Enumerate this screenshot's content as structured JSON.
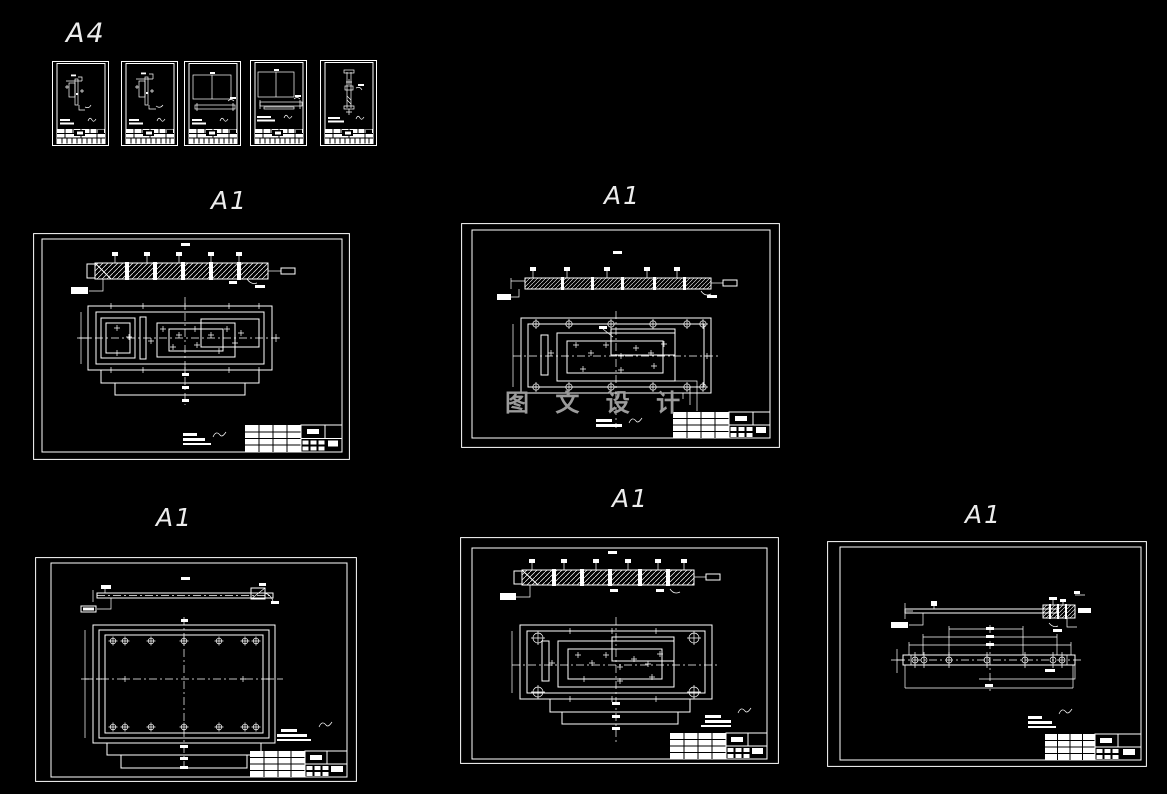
{
  "page": {
    "background_color": "#000000",
    "line_color": "#ffffff",
    "watermark_color": "#9b9b9b"
  },
  "labels": {
    "a4_group": "A4",
    "a1_top_left": "A1",
    "a1_top_center": "A1",
    "a1_bottom_left": "A1",
    "a1_bottom_center": "A1",
    "a1_bottom_right": "A1"
  },
  "watermark": {
    "text": "图 文 设 计"
  }
}
